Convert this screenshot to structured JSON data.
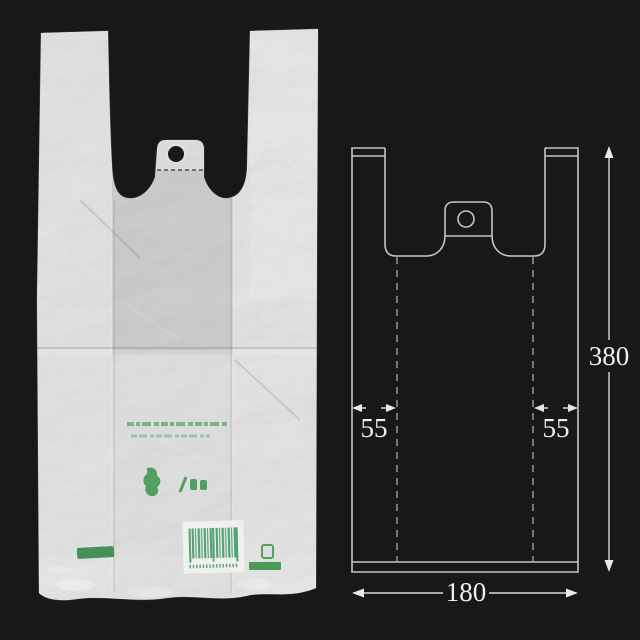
{
  "scene": {
    "background": "#181818"
  },
  "photo": {
    "plastic_color": "#b9b9b7",
    "print_color": "#2f9141",
    "barcode_label_color": "#f0f2ec",
    "barcode_bar_color": "#55a075",
    "icons": [
      "eco-mark-icon",
      "pla-mark-icon",
      "barcode-label",
      "recycle-emblem-icon",
      "green-strip",
      "hanging-hole"
    ]
  },
  "diagram": {
    "line_color": "#c5c5c5",
    "dash_color": "#9e9e9e",
    "text_color": "#efefef",
    "labels": {
      "height": "380",
      "width": "180",
      "gusset_left": "55",
      "gusset_right": "55"
    }
  }
}
